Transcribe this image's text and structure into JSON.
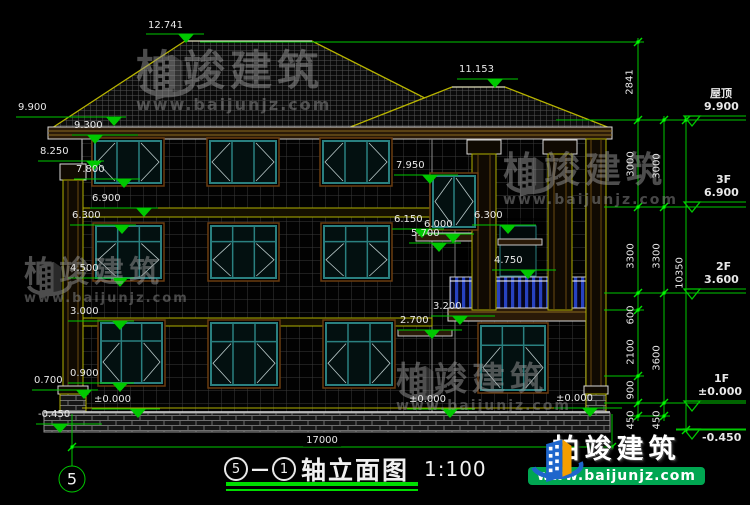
{
  "title": {
    "axis_start": "5",
    "separator": "—",
    "axis_end": "1",
    "name": "轴立面图",
    "scale": "1:100"
  },
  "axis_bubble": "5",
  "dimensions": {
    "bottom_total": "17000",
    "vertical": [
      {
        "text": "2841",
        "x": 630,
        "y": 82
      },
      {
        "text": "3000",
        "x": 631,
        "y": 164
      },
      {
        "text": "3000",
        "x": 657,
        "y": 166
      },
      {
        "text": "3300",
        "x": 631,
        "y": 256
      },
      {
        "text": "3300",
        "x": 657,
        "y": 256
      },
      {
        "text": "10350",
        "x": 680,
        "y": 273
      },
      {
        "text": "600",
        "x": 631,
        "y": 315
      },
      {
        "text": "2100",
        "x": 631,
        "y": 352
      },
      {
        "text": "3600",
        "x": 657,
        "y": 358
      },
      {
        "text": "900",
        "x": 631,
        "y": 390
      },
      {
        "text": "450",
        "x": 631,
        "y": 420
      },
      {
        "text": "450",
        "x": 657,
        "y": 420
      }
    ]
  },
  "elevation_markers": [
    {
      "label": "12.741",
      "lx": 148,
      "ly": 21,
      "x1": 146,
      "x2": 204,
      "yl": 34,
      "tx": 186
    },
    {
      "label": "11.153",
      "lx": 459,
      "ly": 65,
      "x1": 457,
      "x2": 518,
      "yl": 79,
      "tx": 495
    },
    {
      "label": "9.900",
      "lx": 18,
      "ly": 103,
      "x1": 16,
      "x2": 126,
      "yl": 117,
      "tx": 114
    },
    {
      "label": "9.300",
      "lx": 74,
      "ly": 121,
      "x1": 72,
      "x2": 138,
      "yl": 135,
      "tx": 95
    },
    {
      "label": "8.250",
      "lx": 40,
      "ly": 147,
      "x1": 38,
      "x2": 104,
      "yl": 161,
      "tx": 94
    },
    {
      "label": "7.800",
      "lx": 76,
      "ly": 165,
      "x1": 74,
      "x2": 140,
      "yl": 179,
      "tx": 124
    },
    {
      "label": "6.900",
      "lx": 92,
      "ly": 194,
      "x1": 90,
      "x2": 158,
      "yl": 208,
      "tx": 144
    },
    {
      "label": "6.300",
      "lx": 72,
      "ly": 211,
      "x1": 70,
      "x2": 136,
      "yl": 225,
      "tx": 122
    },
    {
      "label": "4.500",
      "lx": 70,
      "ly": 264,
      "x1": 68,
      "x2": 134,
      "yl": 278,
      "tx": 120
    },
    {
      "label": "3.000",
      "lx": 70,
      "ly": 307,
      "x1": 68,
      "x2": 134,
      "yl": 321,
      "tx": 120
    },
    {
      "label": "0.900",
      "lx": 70,
      "ly": 369,
      "x1": 68,
      "x2": 134,
      "yl": 383,
      "tx": 120
    },
    {
      "label": "0.700",
      "lx": 34,
      "ly": 376,
      "x1": 32,
      "x2": 98,
      "yl": 390,
      "tx": 84
    },
    {
      "label": "±0.000",
      "lx": 94,
      "ly": 395,
      "x1": 92,
      "x2": 160,
      "yl": 409,
      "tx": 138
    },
    {
      "label": "-0.450",
      "lx": 38,
      "ly": 410,
      "x1": 36,
      "x2": 102,
      "yl": 424,
      "tx": 60
    },
    {
      "label": "7.950",
      "lx": 396,
      "ly": 161,
      "x1": 394,
      "x2": 458,
      "yl": 175,
      "tx": 430
    },
    {
      "label": "6.150",
      "lx": 394,
      "ly": 215,
      "x1": 392,
      "x2": 444,
      "yl": 229,
      "tx": 422
    },
    {
      "label": "6.000",
      "lx": 424,
      "ly": 220,
      "x1": 422,
      "x2": 474,
      "yl": 234,
      "tx": 453
    },
    {
      "label": "5.700",
      "lx": 411,
      "ly": 229,
      "x1": 409,
      "x2": 461,
      "yl": 243,
      "tx": 439
    },
    {
      "label": "6.300",
      "lx": 474,
      "ly": 211,
      "x1": 472,
      "x2": 536,
      "yl": 225,
      "tx": 508
    },
    {
      "label": "4.750",
      "lx": 494,
      "ly": 256,
      "x1": 492,
      "x2": 556,
      "yl": 270,
      "tx": 528
    },
    {
      "label": "3.200",
      "lx": 433,
      "ly": 302,
      "x1": 431,
      "x2": 495,
      "yl": 316,
      "tx": 460
    },
    {
      "label": "2.700",
      "lx": 400,
      "ly": 316,
      "x1": 398,
      "x2": 462,
      "yl": 330,
      "tx": 432
    },
    {
      "label": "±0.000",
      "lx": 409,
      "ly": 395,
      "x1": 407,
      "x2": 475,
      "yl": 409,
      "tx": 450
    },
    {
      "label": "±0.000",
      "lx": 556,
      "ly": 394,
      "x1": 554,
      "x2": 622,
      "yl": 408,
      "tx": 590
    }
  ],
  "floor_markers": [
    {
      "name": "屋顶",
      "value": "9.900",
      "nx": 710,
      "ny": 88,
      "vx": 704,
      "vy": 101,
      "x1": 684,
      "x2": 746,
      "yl": 116,
      "tx": 692
    },
    {
      "name": "3F",
      "value": "6.900",
      "nx": 716,
      "ny": 174,
      "vx": 704,
      "vy": 187,
      "x1": 684,
      "x2": 746,
      "yl": 202,
      "tx": 692
    },
    {
      "name": "2F",
      "value": "3.600",
      "nx": 716,
      "ny": 261,
      "vx": 704,
      "vy": 274,
      "x1": 684,
      "x2": 746,
      "yl": 289,
      "tx": 692
    },
    {
      "name": "1F",
      "value": "±0.000",
      "nx": 714,
      "ny": 373,
      "vx": 698,
      "vy": 386,
      "x1": 684,
      "x2": 746,
      "yl": 401,
      "tx": 692
    },
    {
      "name": "",
      "value": "-0.450",
      "nx": 0,
      "ny": 0,
      "vx": 702,
      "vy": 432,
      "x1": 676,
      "x2": 746,
      "yl": 429,
      "tx": 692
    }
  ],
  "watermarks": [
    {
      "brand": "柏竣建筑",
      "url": "www.baijunjz.com"
    },
    {
      "brand": "柏竣建筑",
      "url": "www.baijunjz.com"
    },
    {
      "brand": "柏竣建筑",
      "url": "www.baijunjz.com"
    },
    {
      "brand": "柏竣建筑",
      "url": "www.baijunjz.com"
    }
  ],
  "logo": {
    "brand": "柏竣建筑",
    "url": "www.baijunjz.com"
  }
}
